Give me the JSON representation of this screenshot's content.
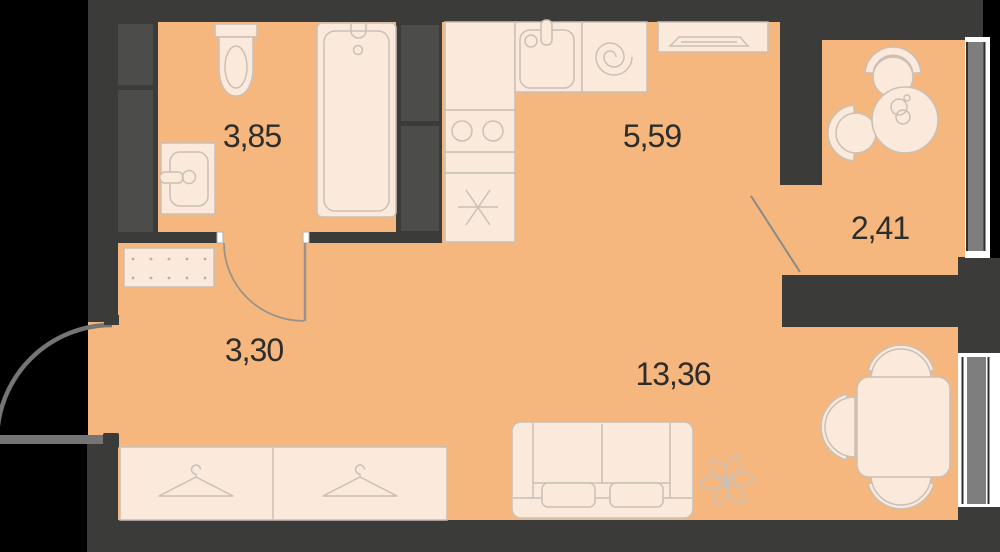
{
  "floorplan": {
    "rooms": [
      {
        "name": "bathroom",
        "area": "3,85"
      },
      {
        "name": "kitchen",
        "area": "5,59"
      },
      {
        "name": "balcony",
        "area": "2,41"
      },
      {
        "name": "hallway",
        "area": "3,30"
      },
      {
        "name": "living-room",
        "area": "13,36"
      }
    ],
    "colors": {
      "background": "#000000",
      "floor": "#F6B77E",
      "walls": "#3B3B39",
      "vent_shafts": "#4C4C4A",
      "furniture_fill": "#FBE9DC",
      "furniture_stroke": "#C9C0B6",
      "door_gray": "#757575",
      "window_glass": "#7E7E7E",
      "window_frame_white": "#FFFFFF",
      "label_text": "#2D2D2B"
    }
  }
}
